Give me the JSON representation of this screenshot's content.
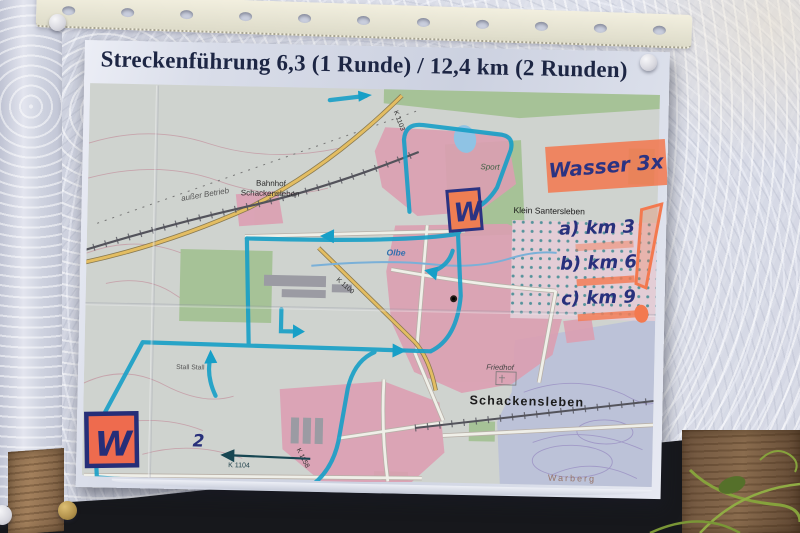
{
  "photo": {
    "title": "Streckenführung 6,3 (1 Runde) / 12,4 km (2 Runden)",
    "annotations": {
      "wasser": "Wasser 3x",
      "water_points": [
        "a) km 3",
        "b) km 6",
        "c) km 9"
      ],
      "exclamation": "!",
      "w_station_top": "W",
      "w_station_bottom": "W",
      "lap_number": "2",
      "colors": {
        "highlighter_orange": "#f37a52",
        "marker_navy": "#2b3382",
        "route_teal": "#179fc7"
      }
    },
    "map_labels": {
      "bahnhof_line1": "Bahnhof",
      "bahnhof_line2": "Schackensleben",
      "ausser_betrieb": "außer Betrieb",
      "klein_santersleben": "Klein Santersleben",
      "sport": "Sport",
      "friedhof": "Friedhof",
      "schackensleben": "Schackensleben",
      "warberg": "Warberg",
      "olbe": "Olbe",
      "stall": "Stall Stall",
      "k1103": "K 1103",
      "k1100": "K 1100",
      "k1104": "K 1104",
      "k1158": "K 1158"
    }
  }
}
